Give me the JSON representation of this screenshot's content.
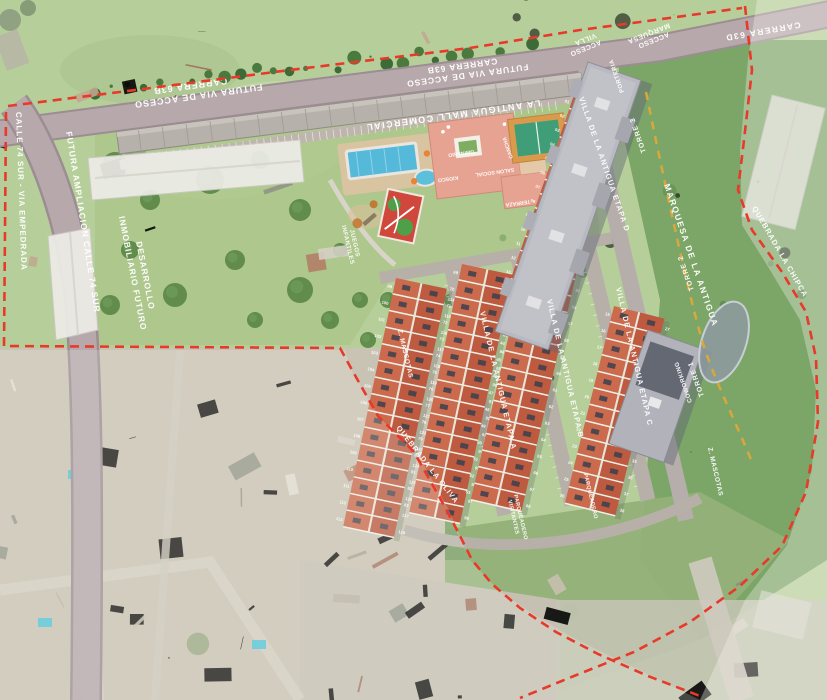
{
  "colors": {
    "boundary_red": "#e8392a",
    "construction_yellow": "#d9a83c",
    "roof_red": "#cb6a4c",
    "roof_red_dark": "#bd5a3f",
    "tower_gray": "#b9b9c1",
    "road_gray": "#b3a6a9",
    "pool_blue": "#55b9d9",
    "court_green": "#3f9e77",
    "label_white": "#ffffff"
  },
  "roads": {
    "calle_74": "CALLE 74 SUR - VIA EMPEDRADA",
    "ampliacion": "FUTURA AMPLIACION CALLE 74 SUR",
    "acceso1_l1": "FUTURA VIA DE ACCESO",
    "acceso1_l2": "CARRERA 63B",
    "acceso2_l1": "FUTURA VIA DE ACCESO",
    "acceso2_l2": "CARRERA 63B",
    "carrera_63d": "CARRERA 63D",
    "acceso_villa_l1": "ACCESO",
    "acceso_villa_l2": "VILLA",
    "acceso_marquesa_l1": "ACCESO",
    "acceso_marquesa_l2": "MARQUESA"
  },
  "context": {
    "desarrollo_l1": "DESARROLLO",
    "desarrollo_l2": "INMOBILIARIO FUTURO",
    "quebrada_east": "QUEBRADA LA CHIPCA",
    "quebrada_west": "QUEBRADA LA OLIVA"
  },
  "project": {
    "mall": "LA ANTIGUA MALL COMERCIAL",
    "porteria": "PORTERIA",
    "marquesa": "MARQUESA DE LA ANTIGUA",
    "torre_top": "TORRE 3",
    "torre_mid": "TORRE 2",
    "torre_bottom": "TORRE 1",
    "coworking": "COWORKING",
    "etapa_a": "VILLA DE LA ANTIGUA ETAPA A",
    "etapa_b": "VILLA DE LA ANTIGUA ETAPA B",
    "etapa_c": "VILLA DE LA ANTIGUA ETAPA C",
    "etapa_d": "VILLA DE LA ANTIGUA ETAPA D",
    "amenities": {
      "juegos_l1": "JUEGOS",
      "juegos_l2": "INFANTILES",
      "mascotas_w": "Z. MASCOTAS",
      "mascotas_e": "Z. MASCOTAS",
      "gimnasio": "GIMNASIO",
      "salon": "SALON SOCIAL",
      "kiosco": "KIOSCO",
      "terraza": "TERRAZA",
      "cancha": "CANCHA",
      "parq_l1": "PARQUEADERO",
      "parq_l2": "VISITANTES",
      "parq2": "PARQUEADERO"
    }
  },
  "housing": {
    "rows": [
      {
        "etapa": "A",
        "start": 99,
        "end": 128
      },
      {
        "etapa": "A",
        "start": 69,
        "end": 98
      },
      {
        "etapa": "B",
        "start": 39,
        "end": 68
      },
      {
        "etapa": "C",
        "start": 15,
        "end": 38
      },
      {
        "etapa": "D",
        "start": 1,
        "end": 14
      }
    ]
  }
}
